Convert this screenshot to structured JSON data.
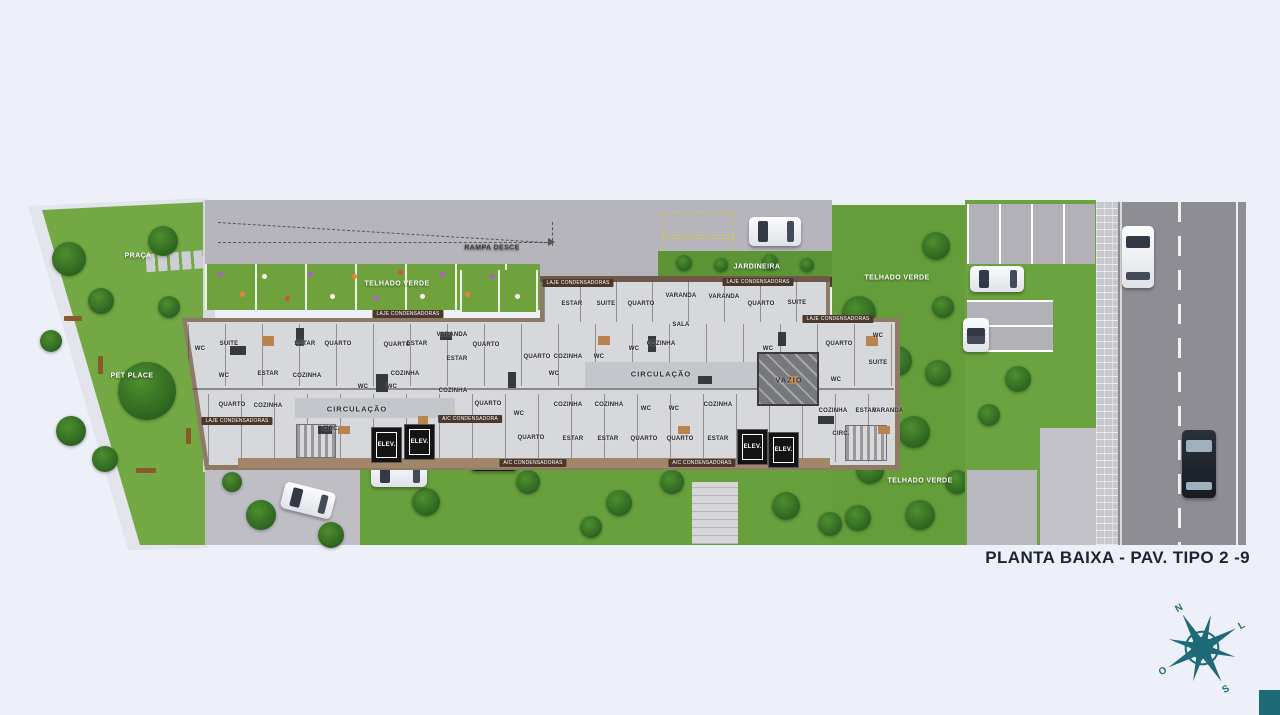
{
  "scene": {
    "background": "#edeff9",
    "accent_teal": "#1d6b77",
    "title": "PLANTA BAIXA  - PAV. TIPO 2 -9",
    "title_color": "#1c2433"
  },
  "site_labels": [
    {
      "text": "PRAÇA",
      "x": 138,
      "y": 256,
      "color": "#ffffff"
    },
    {
      "text": "PET PLACE",
      "x": 132,
      "y": 376,
      "color": "#ffffff"
    },
    {
      "text": "RAMPA DESCE",
      "x": 492,
      "y": 248,
      "color": "#3a3a3a"
    },
    {
      "text": "TELHADO VERDE",
      "x": 397,
      "y": 284,
      "color": "#ffffff"
    },
    {
      "text": "JARDINEIRA",
      "x": 757,
      "y": 267,
      "color": "#ffffff"
    },
    {
      "text": "TELHADO VERDE",
      "x": 897,
      "y": 278,
      "color": "#ffffff"
    },
    {
      "text": "TELHADO VERDE",
      "x": 920,
      "y": 481,
      "color": "#ffffff"
    }
  ],
  "building": {
    "elevator_label": "ELEV.",
    "elevators": [
      {
        "x": 371,
        "y": 427
      },
      {
        "x": 404,
        "y": 424
      },
      {
        "x": 737,
        "y": 429
      },
      {
        "x": 768,
        "y": 432
      }
    ],
    "rooms": [
      {
        "t": "WC",
        "x": 200,
        "y": 349
      },
      {
        "t": "SUITE",
        "x": 229,
        "y": 344
      },
      {
        "t": "WC",
        "x": 224,
        "y": 376
      },
      {
        "t": "QUARTO",
        "x": 232,
        "y": 405
      },
      {
        "t": "ESTAR",
        "x": 268,
        "y": 374
      },
      {
        "t": "COZINHA",
        "x": 268,
        "y": 406
      },
      {
        "t": "ESTAR",
        "x": 305,
        "y": 344
      },
      {
        "t": "COZINHA",
        "x": 307,
        "y": 376
      },
      {
        "t": "QUARTO",
        "x": 338,
        "y": 344
      },
      {
        "t": "QUARTO",
        "x": 397,
        "y": 345
      },
      {
        "t": "WC",
        "x": 363,
        "y": 387
      },
      {
        "t": "WC",
        "x": 392,
        "y": 387
      },
      {
        "t": "ESTAR",
        "x": 417,
        "y": 344
      },
      {
        "t": "COZINHA",
        "x": 405,
        "y": 374
      },
      {
        "t": "VARANDA",
        "x": 452,
        "y": 335
      },
      {
        "t": "ESTAR",
        "x": 457,
        "y": 359
      },
      {
        "t": "COZINHA",
        "x": 453,
        "y": 391
      },
      {
        "t": "QUARTO",
        "x": 486,
        "y": 345
      },
      {
        "t": "QUARTO",
        "x": 488,
        "y": 404
      },
      {
        "t": "WC",
        "x": 519,
        "y": 414
      },
      {
        "t": "QUARTO",
        "x": 531,
        "y": 438
      },
      {
        "t": "QUARTO",
        "x": 537,
        "y": 357
      },
      {
        "t": "WC",
        "x": 554,
        "y": 374
      },
      {
        "t": "ESTAR",
        "x": 572,
        "y": 304
      },
      {
        "t": "SUITE",
        "x": 606,
        "y": 304
      },
      {
        "t": "QUARTO",
        "x": 641,
        "y": 304
      },
      {
        "t": "COZINHA",
        "x": 568,
        "y": 357
      },
      {
        "t": "WC",
        "x": 599,
        "y": 357
      },
      {
        "t": "WC",
        "x": 634,
        "y": 349
      },
      {
        "t": "COZINHA",
        "x": 568,
        "y": 405
      },
      {
        "t": "COZINHA",
        "x": 609,
        "y": 405
      },
      {
        "t": "ESTAR",
        "x": 573,
        "y": 439
      },
      {
        "t": "ESTAR",
        "x": 608,
        "y": 439
      },
      {
        "t": "WC",
        "x": 646,
        "y": 409
      },
      {
        "t": "WC",
        "x": 674,
        "y": 409
      },
      {
        "t": "QUARTO",
        "x": 644,
        "y": 439
      },
      {
        "t": "QUARTO",
        "x": 680,
        "y": 439
      },
      {
        "t": "COZINHA",
        "x": 718,
        "y": 405
      },
      {
        "t": "ESTAR",
        "x": 718,
        "y": 439
      },
      {
        "t": "VARANDA",
        "x": 681,
        "y": 296
      },
      {
        "t": "VARANDA",
        "x": 724,
        "y": 297
      },
      {
        "t": "QUARTO",
        "x": 761,
        "y": 304
      },
      {
        "t": "SUITE",
        "x": 797,
        "y": 303
      },
      {
        "t": "SALA",
        "x": 681,
        "y": 325
      },
      {
        "t": "COZINHA",
        "x": 661,
        "y": 344
      },
      {
        "t": "WC",
        "x": 768,
        "y": 349
      },
      {
        "t": "CIRCULAÇÃO",
        "x": 661,
        "y": 374,
        "big": true
      },
      {
        "t": "CIRCULAÇÃO",
        "x": 357,
        "y": 409,
        "big": true
      },
      {
        "t": "CIRC.",
        "x": 331,
        "y": 429
      },
      {
        "t": "CIRC.",
        "x": 841,
        "y": 434
      },
      {
        "t": "VAZIO",
        "x": 789,
        "y": 380,
        "big": true
      },
      {
        "t": "QUARTO",
        "x": 839,
        "y": 344
      },
      {
        "t": "WC",
        "x": 878,
        "y": 336
      },
      {
        "t": "SUITE",
        "x": 878,
        "y": 363
      },
      {
        "t": "WC",
        "x": 836,
        "y": 380
      },
      {
        "t": "COZINHA",
        "x": 833,
        "y": 411
      },
      {
        "t": "ESTAR",
        "x": 866,
        "y": 411
      },
      {
        "t": "VARANDA",
        "x": 888,
        "y": 411
      }
    ],
    "strips": [
      {
        "text": "LAJE CONDENSADORAS",
        "x": 237,
        "y": 421
      },
      {
        "text": "LAJE CONDENSADORAS",
        "x": 408,
        "y": 314
      },
      {
        "text": "LAJE CONDENSADORAS",
        "x": 578,
        "y": 283
      },
      {
        "text": "LAJE CONDENSADORAS",
        "x": 758,
        "y": 282
      },
      {
        "text": "LAJE CONDENSADORAS",
        "x": 838,
        "y": 319
      },
      {
        "text": "A/C CONDENSADORAS",
        "x": 533,
        "y": 463
      },
      {
        "text": "A/C CONDENSADORAS",
        "x": 702,
        "y": 463
      },
      {
        "text": "A/C CONDENSADORA",
        "x": 470,
        "y": 419
      }
    ]
  },
  "compass": {
    "north": "N",
    "east": "L",
    "south": "S",
    "west": "O"
  }
}
